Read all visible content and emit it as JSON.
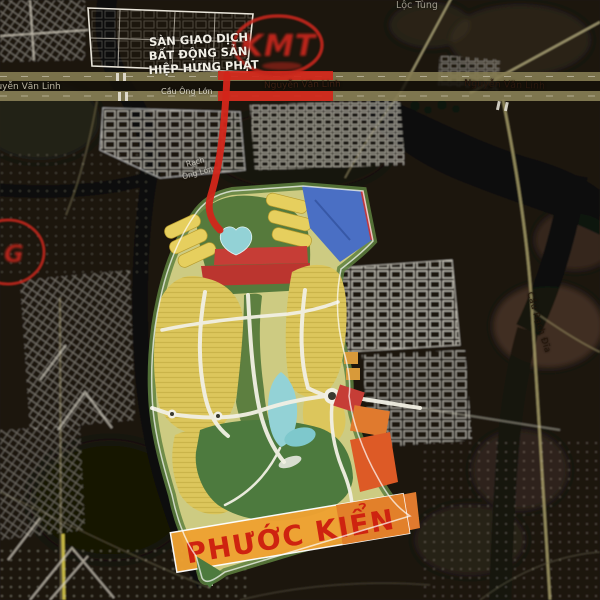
{
  "colors": {
    "route_red": "#d3261a",
    "logo_red": "#c4251d",
    "plan_base": "#cdcb82",
    "plan_green": "#567a3c",
    "golf_green": "#4d7a3e",
    "lake_blue": "#93d2d6",
    "block_red": "#c63d36",
    "block_red_dark": "#bb352f",
    "block_yellow": "#e6cf5e",
    "yellow_mass": "#dcc65c",
    "block_orange": "#e07a2e",
    "orange_deep": "#dd5a26",
    "band_orange": "#efa232",
    "band_orange_dark": "#e2802a",
    "blue_wedge": "#4a6fc4",
    "phuoc_red": "#ce2310",
    "label_white": "#f2efe6",
    "label_dark": "#3d2012"
  },
  "watermarks": {
    "center_logo": "KMT",
    "left_logo": "G"
  },
  "labels": {
    "agency_line1": "SÀN GIAO DỊCH",
    "agency_line2": "BẤT ĐỘNG SẢN",
    "agency_line3": "HIỆP HƯNG PHÁT",
    "road_nvl_left": "Nguyễn Văn Linh",
    "road_nvl_center": "Nguyễn Văn Linh",
    "road_nvl_right": "Nguyễn Văn Linh",
    "bridge_ong_lon": "Cầu Ông Lớn",
    "canal_rach": "Rạch",
    "canal_ong_lon": "Ông Lớn",
    "top_right_area": "Lộc Tùng",
    "bridge_rach_dia": "Cầu Rạch Đĩa",
    "area_name": "PHƯỚC KIỂN"
  }
}
